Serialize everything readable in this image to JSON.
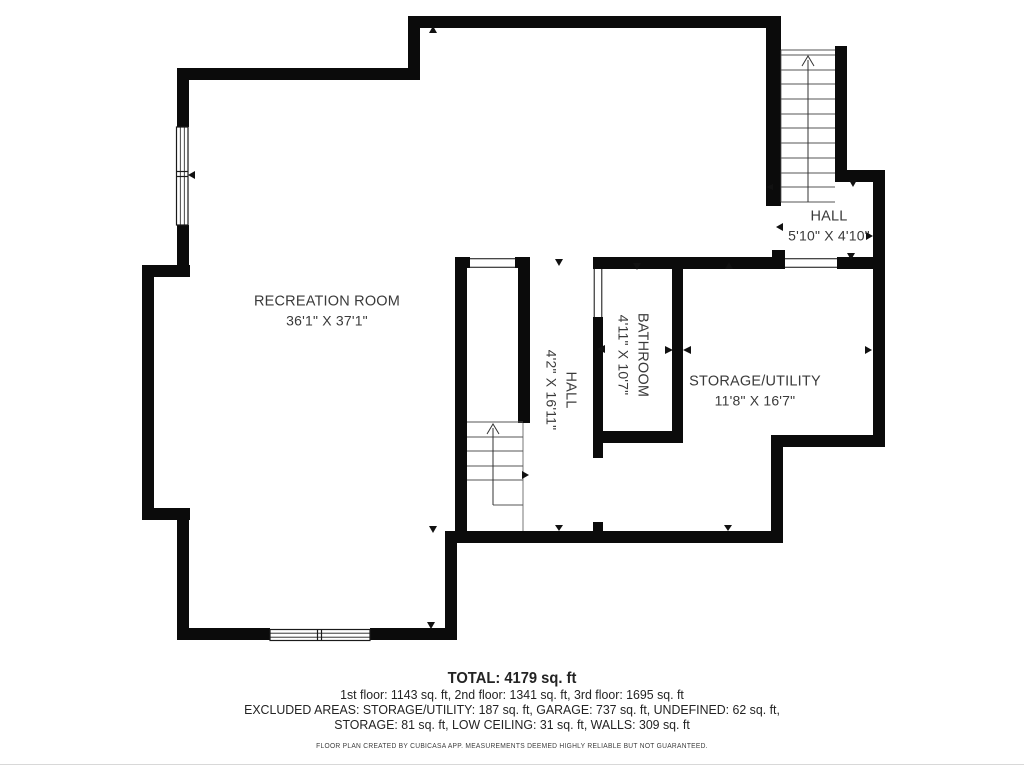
{
  "plan": {
    "rooms": [
      {
        "name": "RECREATION ROOM",
        "dims": "36'1\" X 37'1\"",
        "orientation": "horizontal"
      },
      {
        "name": "HALL",
        "dims": "4'2\" X 16'11\"",
        "orientation": "vertical"
      },
      {
        "name": "BATHROOM",
        "dims": "4'11\" X 10'7\"",
        "orientation": "vertical"
      },
      {
        "name": "STORAGE/UTILITY",
        "dims": "11'8\" X 16'7\"",
        "orientation": "horizontal"
      },
      {
        "name": "HALL",
        "dims": "5'10\" X 4'10\"",
        "orientation": "horizontal"
      }
    ],
    "features": {
      "staircases": 2,
      "windows": 2,
      "stair_direction": "up"
    },
    "colors": {
      "wall": "#0b0b0b",
      "label_text": "#3a3a3a",
      "summary_text": "#232323"
    }
  },
  "summary": {
    "total": "TOTAL: 4179 sq. ft",
    "floors": "1st floor: 1143 sq. ft, 2nd floor: 1341 sq. ft, 3rd floor: 1695 sq. ft",
    "excluded_line1": "EXCLUDED AREAS: STORAGE/UTILITY: 187 sq. ft, GARAGE: 737 sq. ft, UNDEFINED: 62 sq. ft,",
    "excluded_line2": "STORAGE: 81 sq. ft, LOW CEILING: 31 sq. ft, WALLS: 309 sq. ft",
    "disclaimer": "FLOOR PLAN CREATED BY CUBICASA APP. MEASUREMENTS DEEMED HIGHLY RELIABLE BUT NOT GUARANTEED."
  }
}
